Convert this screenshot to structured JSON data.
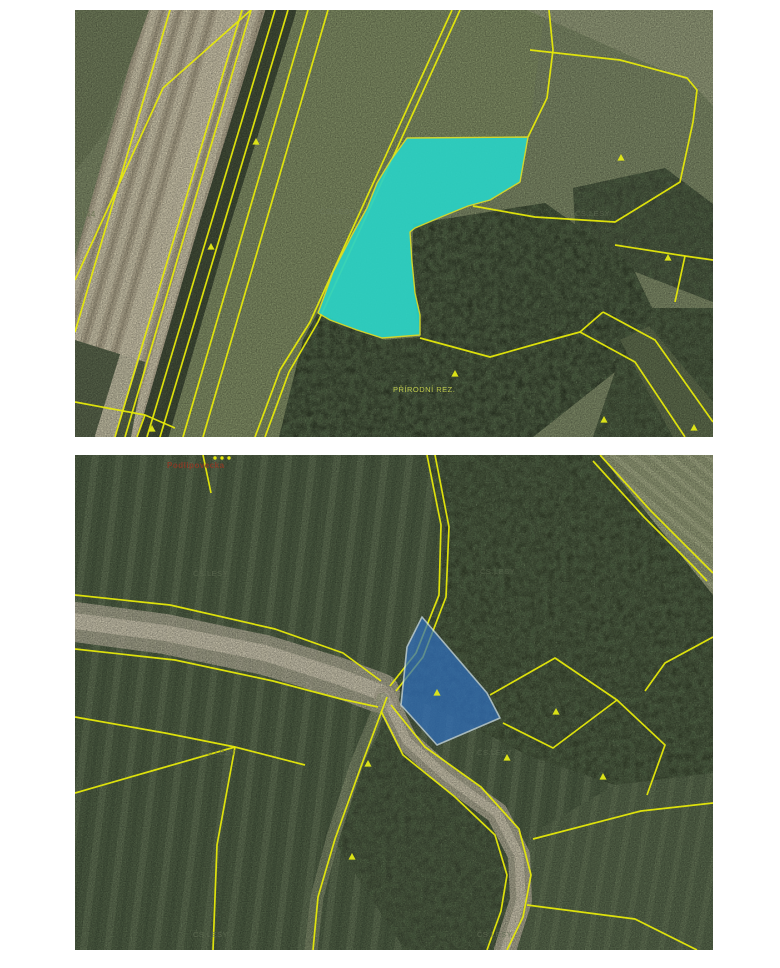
{
  "page": {
    "background": "#ffffff",
    "description_labels_note": "two aerial cadastral orthophoto images"
  },
  "colors": {
    "parcel_line": "#e6e90a",
    "symbol": "#e4ea16",
    "highlight_top": "#2ad2c5",
    "highlight_bottom": "#2f6fbe",
    "road": "#b2ac97",
    "label_faint": "#5f6b52",
    "label_red": "#8a3a26",
    "label_yellow": "#c7d24e"
  },
  "maps": [
    {
      "name": "top",
      "w": 638,
      "h": 427,
      "regions": [
        {
          "name": "base-field",
          "pts": "0,0 638,0 638,427 0,427",
          "fill": "#7b8765"
        },
        {
          "name": "meadow",
          "pts": "205,0 470,0 452,135 338,222 340,330 248,427 82,427",
          "fill": "#7e8b63"
        },
        {
          "name": "plowed-field",
          "pts": "70,0 214,0 86,427 0,427 0,248",
          "fill": "#b3ab92",
          "pattern": "stripesTan",
          "patternOpacity": 0.55
        },
        {
          "name": "grass-top-left",
          "pts": "0,0 74,0 30,122 0,162",
          "fill": "#6f7b5a"
        },
        {
          "name": "grass-bottom-left",
          "pts": "0,330 70,352 56,427 0,427",
          "fill": "#57634a"
        },
        {
          "name": "field-top-right",
          "pts": "452,0 638,0 638,96 616,72 560,48",
          "fill": "#909877"
        },
        {
          "name": "forest-right-edge",
          "pts": "498,178 590,158 638,194 638,292 545,256 500,214",
          "fill": "#414c38",
          "texture": "tex-forest",
          "textureOpacity": 0.9,
          "texture2": "tex-canopy",
          "texture2Opacity": 0.7
        },
        {
          "name": "forest-bottom",
          "pts": "338,214 470,193 556,254 578,300 540,362 458,427 204,427 228,330 243,302 282,320 310,330 345,327 337,270",
          "fill": "#333e2b",
          "texture": "tex-forest",
          "textureOpacity": 0.95,
          "texture2": "tex-canopy",
          "texture2Opacity": 0.8
        },
        {
          "name": "forest-bottom-right",
          "pts": "556,298 638,298 638,427 518,427 540,362 578,300",
          "fill": "#3c4832",
          "texture": "tex-forest",
          "textureOpacity": 0.9,
          "texture2": "tex-canopy",
          "texture2Opacity": 0.7
        },
        {
          "name": "strip-parcel-bottom-right",
          "pts": "545,330 574,316 638,392 638,427 598,427",
          "fill": "#5d6b4c"
        }
      ],
      "bands": [
        {
          "name": "road-surface",
          "pts": "158,0 96,213 30,427",
          "w": 20,
          "color": "#c9c2a9",
          "opacity": 0.9
        },
        {
          "name": "tree-line",
          "pts": "206,0 140,213 78,427",
          "w": 30,
          "color": "#3c4834",
          "opacity": 0.95
        }
      ],
      "lines": [
        {
          "pts": "95,0 0,322"
        },
        {
          "pts": "167,0 40,427"
        },
        {
          "pts": "176,0 50,427"
        },
        {
          "pts": "200,0 72,427"
        },
        {
          "pts": "213,0 85,427"
        },
        {
          "pts": "176,0 88,78 0,270"
        },
        {
          "pts": "233,0 108,427"
        },
        {
          "pts": "253,0 128,427"
        },
        {
          "pts": "377,0 235,312 205,360 180,427"
        },
        {
          "pts": "385,0 243,312 214,362 190,427"
        },
        {
          "pts": "453,127 472,88 478,40 474,0"
        },
        {
          "pts": "455,40 545,50 612,68 622,80 618,112 605,172 540,212 460,207 398,196"
        },
        {
          "pts": "540,235 610,246 638,250"
        },
        {
          "pts": "610,246 600,292"
        },
        {
          "pts": "528,302 580,330 638,412"
        },
        {
          "pts": "505,322 560,352 610,427"
        },
        {
          "pts": "528,302 505,322"
        },
        {
          "pts": "345,328 415,347 468,332 505,322"
        },
        {
          "pts": "0,392 70,405 100,418"
        },
        {
          "pts": "70,405 62,427"
        }
      ],
      "highlight": {
        "name": "highlighted-parcel-cyan",
        "pts": "332,128 453,127 445,172 415,190 393,196 366,207 340,218 335,222 337,252 340,283 345,305 345,325 307,328 282,320 255,310 243,303 258,262 277,225 292,198 302,173 316,150",
        "fill": "#2ad2c5",
        "opacity": 0.92,
        "stroke": "#d9de2e",
        "strokeW": 1.4
      },
      "symbols": [
        [
          181,
          132
        ],
        [
          136,
          237
        ],
        [
          546,
          148
        ],
        [
          593,
          248
        ],
        [
          380,
          364
        ],
        [
          529,
          410
        ],
        [
          77,
          419
        ],
        [
          619,
          418
        ]
      ],
      "dots": [],
      "labels": [
        {
          "text": "144",
          "x": 6,
          "y": 207,
          "fill": "#667050",
          "size": 8,
          "opacity": 0.9
        },
        {
          "text": "ČS.LESY",
          "x": 245,
          "y": 204,
          "fill": "#6f7a62",
          "size": 7.5,
          "opacity": 0.6
        },
        {
          "text": "ČS.LESY",
          "x": 500,
          "y": 206,
          "fill": "#6f7a62",
          "size": 7.5,
          "opacity": 0.55
        },
        {
          "text": "PŘÍRODNÍ REZ.",
          "x": 318,
          "y": 382,
          "fill": "#c7d24e",
          "size": 7.5,
          "opacity": 0.95
        }
      ]
    },
    {
      "name": "bottom",
      "w": 638,
      "h": 495,
      "regions": [
        {
          "name": "base-field",
          "pts": "0,0 638,0 638,495 0,495",
          "fill": "#4e5e44",
          "pattern": "stripesGreen",
          "patternOpacity": 0.5
        },
        {
          "name": "forest-main",
          "pts": "352,0 525,0 638,140 638,318 540,330 452,300 388,266 315,232 340,200 364,145 370,75",
          "fill": "#39452f",
          "texture": "tex-forest",
          "textureOpacity": 0.95,
          "texture2": "tex-canopy",
          "texture2Opacity": 0.8
        },
        {
          "name": "field-top-right",
          "pts": "525,0 638,0 638,140",
          "fill": "#8e9673",
          "pattern": "stripesTR",
          "patternOpacity": 0.6
        },
        {
          "name": "fields-bottom-right",
          "pts": "638,318 638,495 428,495 448,420 468,372 540,330",
          "fill": "#55654a",
          "pattern": "stripesBR",
          "patternOpacity": 0.45
        },
        {
          "name": "forest-wedge-south",
          "pts": "315,258 378,318 428,378 438,438 424,495 330,495 262,390 288,310",
          "fill": "#3f4b36",
          "texture": "tex-forest",
          "textureOpacity": 0.9,
          "texture2": "tex-canopy",
          "texture2Opacity": 0.7
        }
      ],
      "bands": [
        {
          "name": "road-surface-west",
          "pts": "0,167 90,179 190,200 262,222 305,238",
          "w": 40,
          "color": "#b2ac97",
          "opacity": 0.8
        },
        {
          "name": "road-core-west",
          "pts": "0,166 90,178 190,198 262,221 305,237",
          "w": 16,
          "color": "#cdc7b0",
          "opacity": 0.8
        },
        {
          "name": "road-surface-curve",
          "pts": "310,242 332,286 372,322 422,358 444,400 446,445 430,495",
          "w": 22,
          "color": "#b2ac97",
          "opacity": 0.85
        },
        {
          "name": "road-core-curve",
          "pts": "310,242 332,286 372,322 422,358 444,400 446,445 430,495",
          "w": 9,
          "color": "#cdc7b0",
          "opacity": 0.75
        },
        {
          "name": "track-spur",
          "pts": "308,244 282,308 258,382 242,442 236,495",
          "w": 13,
          "color": "#9aa17f",
          "opacity": 0.5
        }
      ],
      "lines": [
        {
          "pts": "0,140 95,150 200,174 268,198 306,226"
        },
        {
          "pts": "0,194 100,205 198,226 266,244 303,252"
        },
        {
          "pts": "352,0 366,70 364,140 341,198 315,231"
        },
        {
          "pts": "360,0 374,72 371,142 348,202 321,236"
        },
        {
          "pts": "312,242 288,306 260,384 243,442 238,495"
        },
        {
          "pts": "316,250 350,292 406,332 444,374 456,420 448,462 432,495"
        },
        {
          "pts": "306,256 328,300 380,342 420,380 432,420 426,456 412,495"
        },
        {
          "pts": "458,384 566,356 638,348"
        },
        {
          "pts": "452,450 560,464 622,495"
        },
        {
          "pts": "525,0 576,56 626,106 638,118"
        },
        {
          "pts": "518,6 569,62 619,112 632,126"
        },
        {
          "pts": "638,182 590,208 570,236"
        },
        {
          "pts": "415,240 480,203 542,245 478,293 428,268"
        },
        {
          "pts": "542,245 590,290 572,340"
        },
        {
          "pts": "0,262 90,278 160,292 230,310"
        },
        {
          "pts": "160,292 142,390 138,495"
        },
        {
          "pts": "0,338 80,315 160,292"
        },
        {
          "pts": "128,0 136,38"
        }
      ],
      "highlight": {
        "name": "highlighted-parcel-blue",
        "pts": "347,162 412,238 425,263 362,290 326,250 332,192",
        "fill": "#2f6fbe",
        "opacity": 0.72,
        "stroke": "#cfe3f2",
        "strokeW": 1.6
      },
      "symbols": [
        [
          362,
          238
        ],
        [
          432,
          303
        ],
        [
          481,
          257
        ],
        [
          528,
          322
        ],
        [
          293,
          309
        ],
        [
          277,
          402
        ]
      ],
      "dots": [
        [
          140,
          3
        ],
        [
          147,
          3
        ],
        [
          154,
          3
        ]
      ],
      "labels": [
        {
          "text": "Podlipovecka",
          "x": 92,
          "y": 13,
          "fill": "#8a3a26",
          "size": 8,
          "opacity": 0.95,
          "bold": true
        },
        {
          "text": "ČS.LESY",
          "x": 118,
          "y": 121,
          "fill": "#5f6b52",
          "size": 7.5,
          "opacity": 0.8
        },
        {
          "text": "ČS.LESY",
          "x": 405,
          "y": 119,
          "fill": "#5f6b52",
          "size": 7.5,
          "opacity": 0.75
        },
        {
          "text": "ČS.LESY",
          "x": 126,
          "y": 300,
          "fill": "#5f6b52",
          "size": 7.5,
          "opacity": 0.8
        },
        {
          "text": "ČS.LESY",
          "x": 402,
          "y": 300,
          "fill": "#5f6b52",
          "size": 7.5,
          "opacity": 0.75
        },
        {
          "text": "ČS.LESY",
          "x": 118,
          "y": 482,
          "fill": "#626e55",
          "size": 7.5,
          "opacity": 0.85
        },
        {
          "text": "ČS.LESY",
          "x": 402,
          "y": 482,
          "fill": "#626e55",
          "size": 7.5,
          "opacity": 0.85
        }
      ]
    }
  ]
}
